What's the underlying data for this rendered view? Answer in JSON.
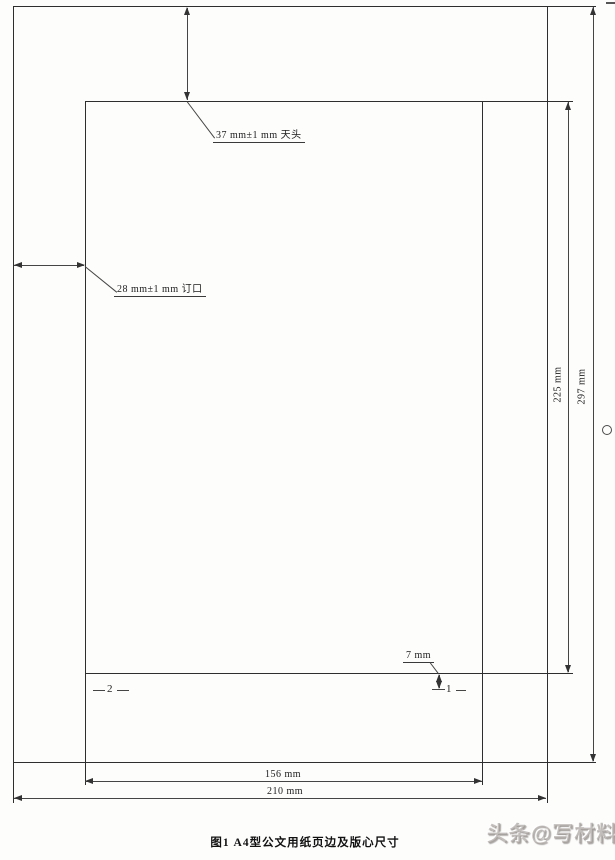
{
  "figure": {
    "caption": "图1  A4型公文用纸页边及版心尺寸",
    "watermark": "头条@写材料"
  },
  "dimensions": {
    "top_margin": "37 mm±1 mm 天头",
    "binding_margin": "28 mm±1 mm 订口",
    "page_number_offset": "7 mm",
    "text_area_width": "156 mm",
    "page_width": "210 mm",
    "text_area_height": "225 mm",
    "page_height": "297 mm"
  },
  "page_markers": {
    "odd": "1",
    "even": "2"
  },
  "colors": {
    "outline": "#2e2e2e",
    "dimension_line": "#454545",
    "watermark": "#9e9894"
  }
}
